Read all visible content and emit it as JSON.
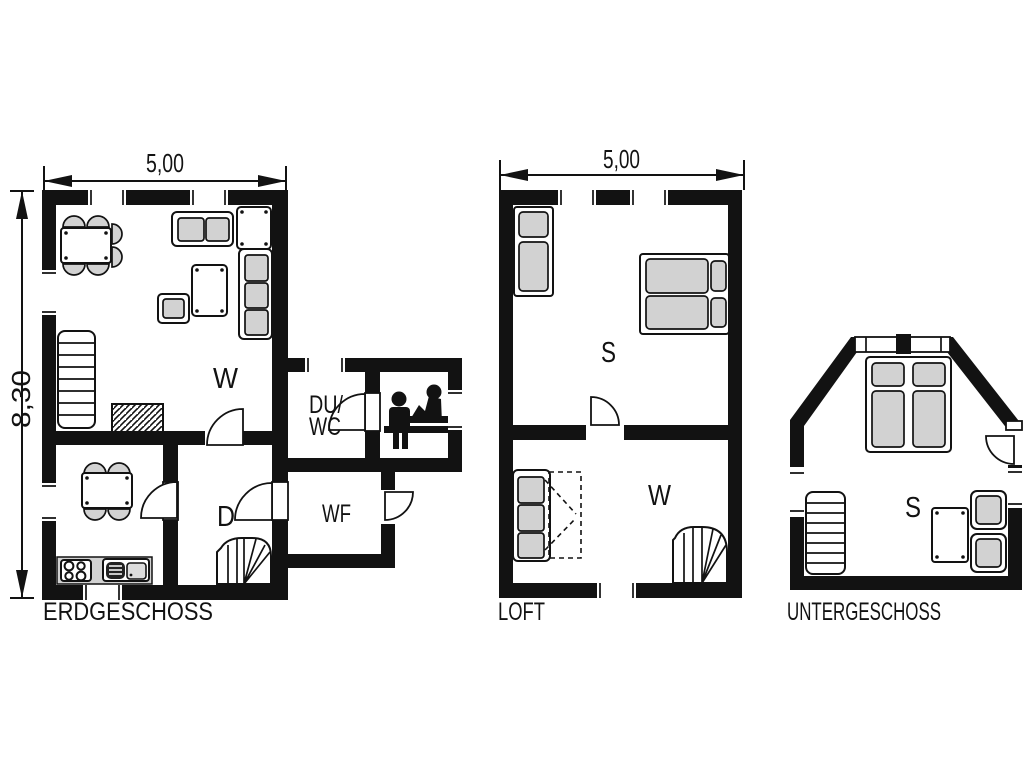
{
  "document_type": "floor-plan-drawing",
  "colors": {
    "walls": "#121212",
    "furniture": "#d2d2d2",
    "background": "#ffffff"
  },
  "icons": {
    "sauna": "sauna-icon",
    "stove": "stove-burners-icon",
    "sink": "kitchen-sink-icon"
  },
  "plans": {
    "erdgeschoss": {
      "title": "ERDGESCHOSS",
      "dim_width": "5,00",
      "dim_height": "8,30",
      "rooms": {
        "living": "W",
        "shower_line1": "DU/",
        "shower_line2": "WC",
        "dining": "D",
        "entry": "WF"
      }
    },
    "loft": {
      "title": "LOFT",
      "dim_width": "5,00",
      "rooms": {
        "bedroom": "S",
        "living": "W"
      }
    },
    "untergeschoss": {
      "title": "UNTERGESCHOSS",
      "rooms": {
        "bedroom": "S"
      }
    }
  }
}
